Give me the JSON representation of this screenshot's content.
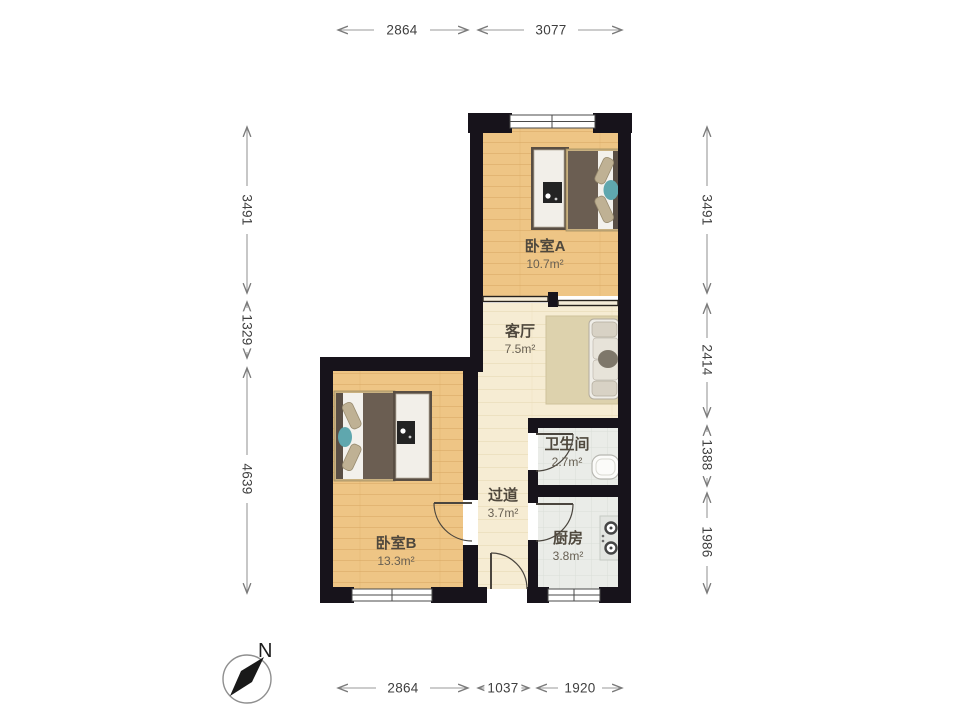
{
  "north": {
    "label": "N"
  },
  "rooms": [
    {
      "id": "bedroom-a",
      "name": "卧室A",
      "area": "10.7m²"
    },
    {
      "id": "living-room",
      "name": "客厅",
      "area": "7.5m²"
    },
    {
      "id": "bathroom",
      "name": "卫生间",
      "area": "2.7m²"
    },
    {
      "id": "hallway",
      "name": "过道",
      "area": "3.7m²"
    },
    {
      "id": "kitchen",
      "name": "厨房",
      "area": "3.8m²"
    },
    {
      "id": "bedroom-b",
      "name": "卧室B",
      "area": "13.3m²"
    }
  ],
  "dimensions_mm": {
    "top": [
      "2864",
      "3077"
    ],
    "bottom": [
      "2864",
      "1037",
      "1920"
    ],
    "left": [
      "3491",
      "1329",
      "4639"
    ],
    "right": [
      "3491",
      "2414",
      "1388",
      "1986"
    ]
  },
  "colors": {
    "wall": "#17131b",
    "wood_floor": "#eec585",
    "cream_floor": "#f6ecd3",
    "tile_floor": "#eaece8",
    "duvet": "#6b5e52",
    "rug": "#ddd2ad",
    "accent_teal": "#5fa7ae"
  }
}
